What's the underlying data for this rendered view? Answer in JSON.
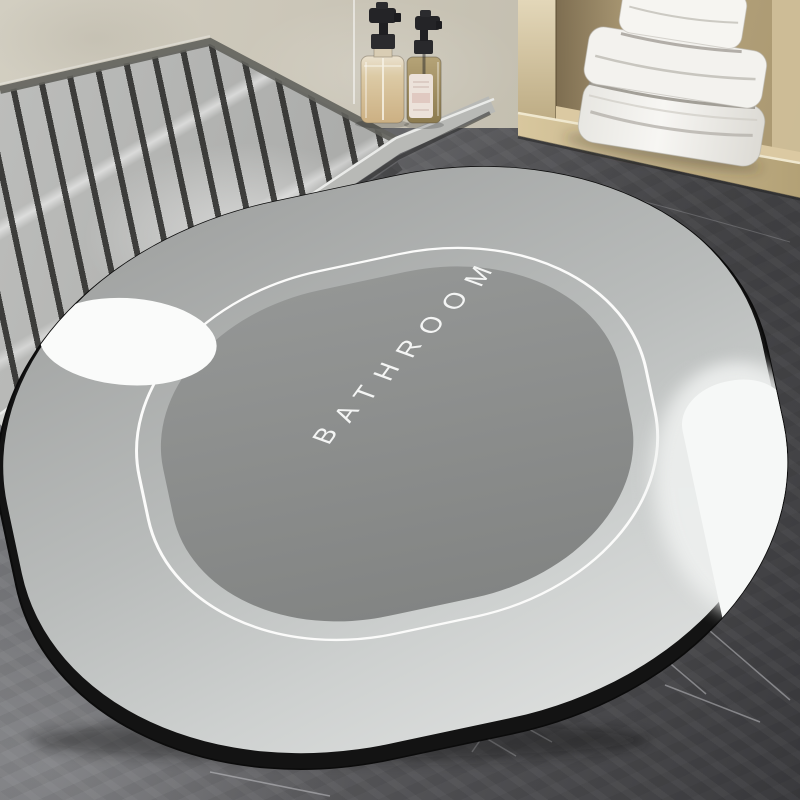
{
  "scene": {
    "type": "product-photo",
    "setting": "bathroom with shower tray, wooden towel cabinet and stone floor",
    "mat": {
      "label": "BATHROOM",
      "shape": "oval bath mat",
      "colors": {
        "edge": "#131313",
        "border": "#c0c3c2",
        "border_highlight": "#f6f8f7",
        "inner_line": "#fbfbfa",
        "center": "#8d8f8e",
        "text": "#f4f5f4"
      }
    },
    "floor": {
      "material": "dark marble concrete",
      "color_light": "#8b8c90",
      "color_dark": "#3a3a3d",
      "vein_color": "#d8d9dd"
    },
    "wall": {
      "material": "beige plaster",
      "color": "#cbc6b8"
    },
    "shower_tray": {
      "material": "gray marble with drain grooves",
      "base_color": "#aaabab",
      "groove_color": "#262624",
      "curb_color": "#b8b9b6",
      "curb_edge_color": "#eaebe9"
    },
    "cabinet": {
      "material": "light wood",
      "color": "#c7b68f",
      "towels": {
        "count": 3,
        "color": "#f3f2ee"
      }
    },
    "bottles": [
      {
        "name": "pump-bottle-large",
        "liquid_color": "#dccaa5",
        "pump_color": "#242427"
      },
      {
        "name": "pump-bottle-small",
        "liquid_color": "#8c7b4f",
        "label_color": "#ece2da",
        "pump_color": "#242427"
      }
    ]
  }
}
